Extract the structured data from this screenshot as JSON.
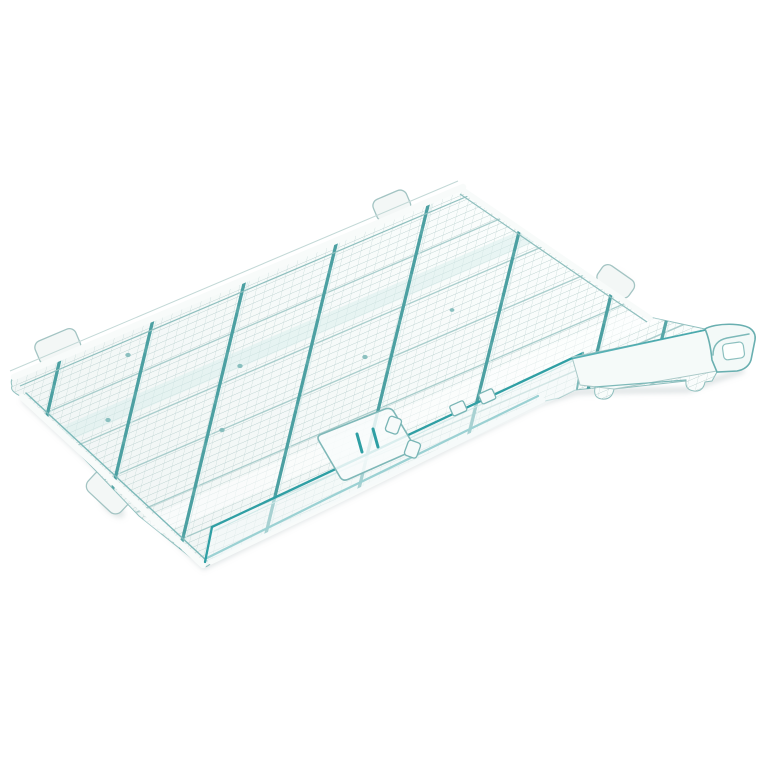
{
  "meta": {
    "type": "product-photo",
    "subject": "Transparent turquoise plastic mesh grid panel",
    "alt": "Transparent teal-tinted plastic grid panel shown at an angle on a white background, with fine rectangular mesh, diagonal reinforcing ribs, small mounting tabs on the edges, a raised front lip, a latch clip at the front edge and a hook-shaped mount on the right side",
    "background": "plain white"
  },
  "palette": {
    "background": "#ffffff",
    "panel_fill": "#f1f6f5",
    "panel_fill_light": "#fafdfc",
    "mesh_line": "#b7cecd",
    "stiffener_line": "#9cc5c4",
    "rib": "#58a7a8",
    "rib_dark": "#3f989b",
    "rib_highlight": "#d9eceb",
    "teal_bright": "#2f9fa4",
    "teal_soft": "#7db9b9",
    "edge_band": "#f8fbfa",
    "edge_hairline": "#8fbfbe",
    "shadow": "#b6c2c3",
    "tab_fill": "#f3f7f6",
    "tab_stroke": "#a3c4c3",
    "dot": "#79b6b6"
  }
}
